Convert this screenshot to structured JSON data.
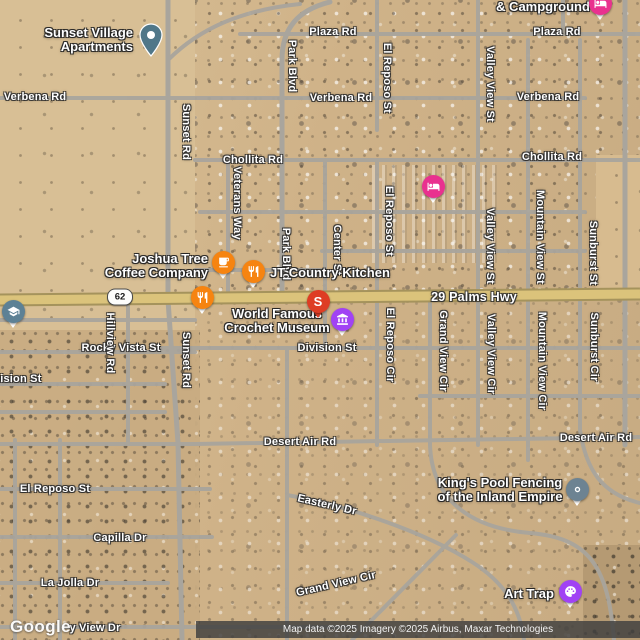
{
  "map_title": "Satellite map of 29 Palms Hwy area, Joshua Tree",
  "attribution": {
    "text": "Map data ©2025 Imagery ©2025 Airbus, Maxar Technologies"
  },
  "watermark": {
    "text": "Google"
  },
  "shield": {
    "route": "62",
    "x": 120,
    "y": 297
  },
  "colors": {
    "food_pin": "#f68411",
    "lodging_pin": "#e9318f",
    "museum_pin": "#a142f4",
    "search_pin": "#de3d24",
    "school_icon": "#5d8195",
    "generic_pin": "#6d8392",
    "apartments_pin": "#507789",
    "highway_fill": "#dbc37b"
  },
  "street_labels": [
    {
      "text": "Plaza Rd",
      "x": 333,
      "y": 32
    },
    {
      "text": "Plaza Rd",
      "x": 557,
      "y": 32
    },
    {
      "text": "Verbena Rd",
      "x": 35,
      "y": 97
    },
    {
      "text": "Verbena Rd",
      "x": 341,
      "y": 98
    },
    {
      "text": "Verbena Rd",
      "x": 548,
      "y": 97
    },
    {
      "text": "Chollita Rd",
      "x": 253,
      "y": 160
    },
    {
      "text": "Chollita Rd",
      "x": 552,
      "y": 157
    },
    {
      "text": "29 Palms Hwy",
      "x": 474,
      "y": 297,
      "size": 12.5
    },
    {
      "text": "Division St",
      "x": 327,
      "y": 348
    },
    {
      "text": "Rocky Vista St",
      "x": 121,
      "y": 348
    },
    {
      "text": "Division St",
      "x": 12,
      "y": 379
    },
    {
      "text": "Desert Air Rd",
      "x": 300,
      "y": 442
    },
    {
      "text": "Desert Air Rd",
      "x": 596,
      "y": 438
    },
    {
      "text": "El Reposo St",
      "x": 55,
      "y": 489
    },
    {
      "text": "Easterly Dr",
      "x": 327,
      "y": 505,
      "rot": 13
    },
    {
      "text": "Capilla Dr",
      "x": 120,
      "y": 538
    },
    {
      "text": "La Jolla Dr",
      "x": 70,
      "y": 583
    },
    {
      "text": "Grand View Cir",
      "x": 336,
      "y": 584,
      "rot": -13
    },
    {
      "text": "y View Dr",
      "x": 95,
      "y": 628
    },
    {
      "text": "Sunset Rd",
      "x": 186,
      "y": 132,
      "rot": 90
    },
    {
      "text": "Sunset Rd",
      "x": 186,
      "y": 360,
      "rot": 90
    },
    {
      "text": "Hillview Rd",
      "x": 110,
      "y": 343,
      "rot": 90
    },
    {
      "text": "Park Blvd",
      "x": 292,
      "y": 66,
      "rot": 90
    },
    {
      "text": "Park Blvd",
      "x": 286,
      "y": 254,
      "rot": 90
    },
    {
      "text": "Veterans Way",
      "x": 237,
      "y": 203,
      "rot": 90
    },
    {
      "text": "Center St",
      "x": 337,
      "y": 250,
      "rot": 90
    },
    {
      "text": "El Reposo St",
      "x": 387,
      "y": 78,
      "rot": 90
    },
    {
      "text": "El Reposo St",
      "x": 389,
      "y": 221,
      "rot": 90
    },
    {
      "text": "El Reposo Cir",
      "x": 390,
      "y": 345,
      "rot": 90
    },
    {
      "text": "Valley View St",
      "x": 490,
      "y": 84,
      "rot": 90
    },
    {
      "text": "Valley View St",
      "x": 490,
      "y": 246,
      "rot": 90
    },
    {
      "text": "Valley View Cir",
      "x": 491,
      "y": 354,
      "rot": 90
    },
    {
      "text": "Mountain View St",
      "x": 540,
      "y": 237,
      "rot": 90
    },
    {
      "text": "Mountain View Cir",
      "x": 542,
      "y": 361,
      "rot": 90
    },
    {
      "text": "Sunburst St",
      "x": 593,
      "y": 253,
      "rot": 90
    },
    {
      "text": "Sunburst Cir",
      "x": 594,
      "y": 347,
      "rot": 90
    },
    {
      "text": "Grand View Cir",
      "x": 443,
      "y": 351,
      "rot": 90
    }
  ],
  "poi_labels": [
    {
      "name": "sunset-village-apartments",
      "lines": [
        "Sunset Village",
        "Apartments"
      ],
      "x": 133,
      "y": 40,
      "align": "right"
    },
    {
      "name": "campground",
      "lines": [
        "& Campground"
      ],
      "x": 543,
      "y": 7,
      "align": "center"
    },
    {
      "name": "joshua-tree-coffee-company",
      "lines": [
        "Joshua Tree",
        "Coffee Company"
      ],
      "x": 208,
      "y": 266,
      "align": "right"
    },
    {
      "name": "jt-country-kitchen",
      "lines": [
        "JT Country Kitchen"
      ],
      "x": 270,
      "y": 273,
      "align": "left"
    },
    {
      "name": "world-famous-crochet-museum",
      "lines": [
        "World Famous",
        "Crochet Museum"
      ],
      "x": 277,
      "y": 321,
      "align": "center"
    },
    {
      "name": "kings-pool-fencing",
      "lines": [
        "King's Pool Fencing",
        "of the Inland Empire"
      ],
      "x": 500,
      "y": 490,
      "align": "center"
    },
    {
      "name": "art-trap",
      "lines": [
        "Art Trap"
      ],
      "x": 529,
      "y": 594,
      "align": "center"
    }
  ],
  "pins": [
    {
      "name": "lodging-pin-campground",
      "icon": "bed-icon",
      "type": "circle",
      "x": 600,
      "y": 3,
      "color": "#e9318f"
    },
    {
      "name": "apartments-pin",
      "icon": "place-icon",
      "type": "teardrop",
      "x": 151,
      "y": 38,
      "color": "#507789"
    },
    {
      "name": "lodging-pin-rv-park",
      "icon": "bed-icon",
      "type": "circle",
      "x": 433,
      "y": 186,
      "color": "#e9318f"
    },
    {
      "name": "cafe-pin",
      "icon": "coffee-icon",
      "type": "circle",
      "x": 223,
      "y": 262,
      "color": "#f68411"
    },
    {
      "name": "restaurant-pin-jt-country-kitchen",
      "icon": "restaurant-icon",
      "type": "circle",
      "x": 253,
      "y": 271,
      "color": "#f68411"
    },
    {
      "name": "restaurant-pin-highway",
      "icon": "restaurant-icon",
      "type": "circle",
      "x": 202,
      "y": 297,
      "color": "#f68411"
    },
    {
      "name": "search-result-pin",
      "icon": "letter-s",
      "type": "letter",
      "letter": "S",
      "x": 318,
      "y": 301,
      "color": "#de3d24"
    },
    {
      "name": "museum-pin",
      "icon": "museum-icon",
      "type": "circle",
      "x": 342,
      "y": 319,
      "color": "#a142f4"
    },
    {
      "name": "school-icon-pin",
      "icon": "school-icon",
      "type": "circle",
      "x": 13,
      "y": 311,
      "color": "#5d8195"
    },
    {
      "name": "generic-pin-kings-pool",
      "icon": "dot-icon",
      "type": "circle",
      "x": 577,
      "y": 489,
      "color": "#6d8392"
    },
    {
      "name": "art-gallery-pin",
      "icon": "palette-icon",
      "type": "circle",
      "x": 570,
      "y": 591,
      "color": "#a142f4"
    }
  ]
}
